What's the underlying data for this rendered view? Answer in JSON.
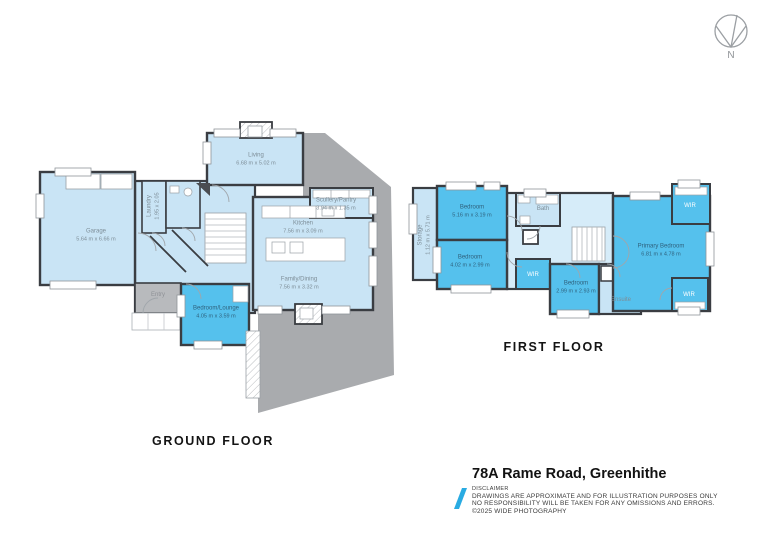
{
  "palette": {
    "room_light": "#c9e4f5",
    "room_hall": "#d6ecf9",
    "room_highlight": "#55c1ed",
    "deck_gray": "#a9abae",
    "entry_gray": "#b8babd",
    "wall": "#3a3d42",
    "accent_blue": "#29abe2"
  },
  "compass": {
    "label": "N"
  },
  "floors": {
    "ground": {
      "title": "GROUND FLOOR",
      "rooms": {
        "living": {
          "name": "Living",
          "dims": "6.68 m x 5.02 m"
        },
        "garage": {
          "name": "Garage",
          "dims": "5.64 m x 6.66 m"
        },
        "laundry": {
          "name": "Laundry",
          "dims": "1.95 x 2.05"
        },
        "scullery": {
          "name": "Scullery/Pantry",
          "dims": "3.94 m x 1.35 m"
        },
        "kitchen": {
          "name": "Kitchen",
          "dims": "7.56 m x 3.09 m"
        },
        "family": {
          "name": "Family/Dining",
          "dims": "7.56 m x 3.32 m"
        },
        "entry": {
          "name": "Entry"
        },
        "bedlounge": {
          "name": "Bedroom/Lounge",
          "dims": "4.05 m x 3.59 m"
        }
      }
    },
    "first": {
      "title": "FIRST FLOOR",
      "rooms": {
        "storage": {
          "name": "Storage",
          "dims": "1.12 m x 5.71 m"
        },
        "bedroom1": {
          "name": "Bedroom",
          "dims": "5.16 m x 3.19 m"
        },
        "bath": {
          "name": "Bath"
        },
        "bedroom2": {
          "name": "Bedroom",
          "dims": "4.02 m x 2.99 m"
        },
        "wir_hall": {
          "name": "WIR"
        },
        "bedroom3": {
          "name": "Bedroom",
          "dims": "2.99 m x 2.93 m"
        },
        "ensuite": {
          "name": "Ensuite"
        },
        "primary": {
          "name": "Primary Bedroom",
          "dims": "6.81 m x 4.78 m"
        },
        "wir_top": {
          "name": "WIR"
        },
        "wir_bottom": {
          "name": "WIR"
        }
      }
    }
  },
  "footer": {
    "address": "78A Rame Road, Greenhithe",
    "disclaimer": {
      "title": "DISCLAIMER",
      "lines": [
        "DRAWINGS ARE APPROXIMATE AND FOR ILLUSTRATION PURPOSES ONLY",
        "NO RESPONSIBILITY WILL BE TAKEN FOR ANY OMISSIONS AND ERRORS.",
        "©2025 WIDE PHOTOGRAPHY"
      ]
    }
  }
}
